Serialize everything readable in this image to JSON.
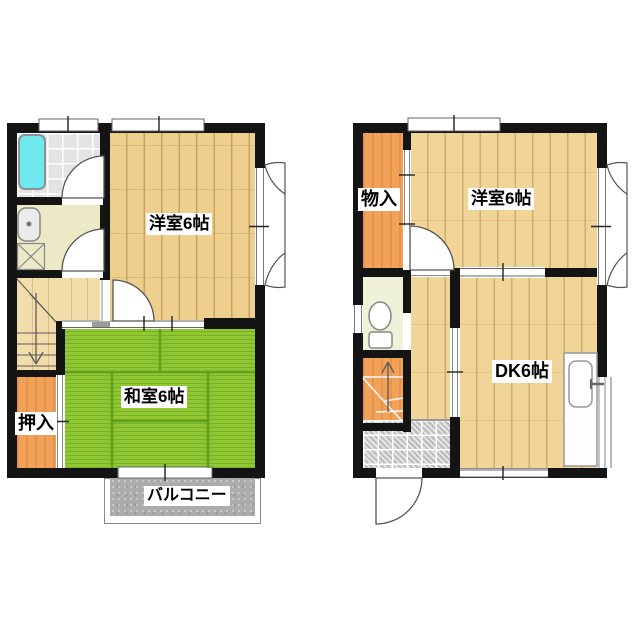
{
  "floor1": {
    "western_room_label": "洋室6帖",
    "japanese_room_label": "和室6帖",
    "closet_label": "押入",
    "balcony_label": "バルコニー"
  },
  "floor2": {
    "storage_label": "物入",
    "western_room_label": "洋室6帖",
    "dining_kitchen_label": "DK6帖"
  },
  "icons": {
    "bathtub": "bathtub-icon",
    "washbasin": "washbasin-icon",
    "washer_pan": "washing-machine-pan-icon",
    "toilet": "toilet-icon",
    "kitchen_sink": "kitchen-sink-icon",
    "stairs_down_arrow": "arrow-down-icon",
    "stairs_up_arrow": "arrow-up-icon",
    "door_swing": "door-swing-arc-icon",
    "casement_window": "casement-window-icon"
  },
  "colors": {
    "wall": "#141414",
    "wood_floor_1f": "#efcf8d",
    "wood_floor_2f": "#f1d497",
    "hallway_wood": "#f2dca9",
    "tatami_green": "#8fc832",
    "tatami_line": "#5fa01e",
    "closet_orange": "#f1a158",
    "balcony_gray": "#acacac",
    "bath_tile": "#e3e3e3",
    "entry_tile": "#cfcfcf",
    "washroom_floor": "#ece9c6",
    "toilet_floor": "#f0f1d9",
    "bathtub_cyan": "#70e9ee"
  }
}
